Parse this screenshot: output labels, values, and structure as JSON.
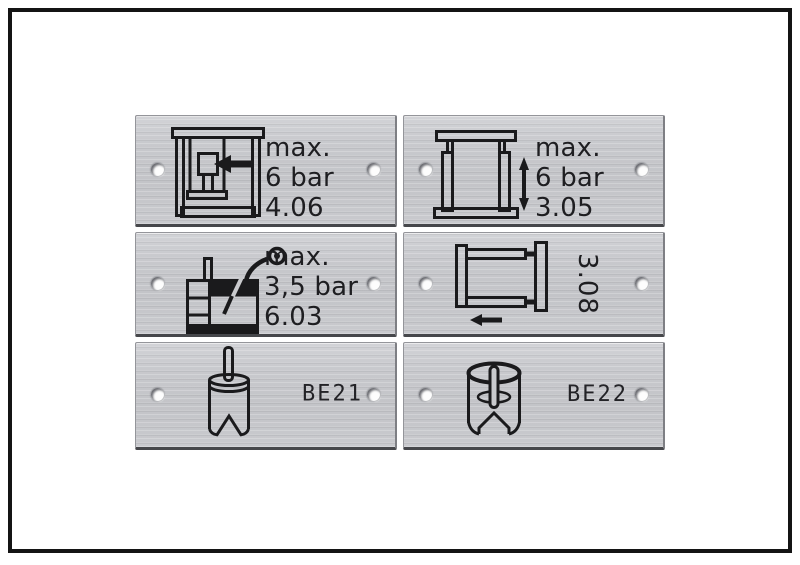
{
  "image": {
    "description": "Six engraved aluminium machine label plates, product photo in black frame",
    "frame_color": "#141414",
    "background": "#ffffff"
  },
  "plate_style": {
    "metal": "#c6c7cb",
    "metal_light": "#d3d4d8",
    "edge_dark": "#46474b",
    "engraving_color": "#1e1e21"
  },
  "plates": [
    {
      "name": "press-plate",
      "icon": "press-frame-arrow-icon",
      "lines": [
        "max.",
        "6 bar",
        "4.06"
      ]
    },
    {
      "name": "lift-plate",
      "icon": "cylinder-frame-updown-icon",
      "lines": [
        "max.",
        "6 bar",
        "3.05"
      ]
    },
    {
      "name": "lubricator-plate",
      "icon": "tank-gauge-icon",
      "lines": [
        "max.",
        "3,5 bar",
        "6.03"
      ]
    },
    {
      "name": "slide-plate",
      "icon": "slide-frame-left-arrow-icon",
      "vertical_label": "3.08"
    },
    {
      "name": "be21-plate",
      "icon": "cylinder-rod-icon",
      "label": "BE21"
    },
    {
      "name": "be22-plate",
      "icon": "cylinder-slot-icon",
      "label": "BE22"
    }
  ]
}
